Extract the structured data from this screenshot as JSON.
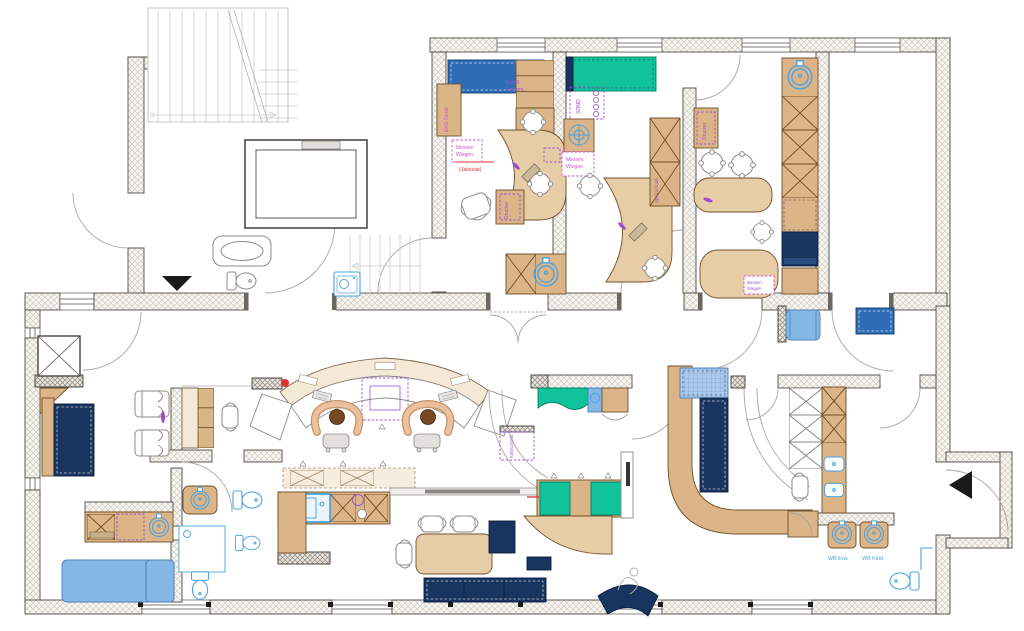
{
  "drawing": {
    "type": "architectural-floor-plan",
    "labels": {
      "notfall_line1": "Notfall",
      "notfall_line2": "Rollcont.",
      "ekg_geraet": "EKG Gerät",
      "messen_line1": "Messen",
      "messen_line2": "Wiegen",
      "jalousie_note": "(Jalousie)",
      "sono": "SONO",
      "drucker": "Drucker",
      "spritzschrank": "Spritzschrank",
      "kuehlschrank": "Kühlschrank",
      "wb_erw": "WB Erw.",
      "wb_kind": "WB Kind"
    },
    "colors": {
      "tan": "#dbb488",
      "tan-edge": "#6e4f28",
      "cream": "#f4e9d7",
      "blue": "#2e6db6",
      "teal": "#10c39b",
      "navy": "#17355f",
      "lightblue": "#85b7e4",
      "skyblue": "#4aa3e2",
      "purple": "#9b4fd0",
      "pink": "#d14fc8",
      "red": "#e03030",
      "skin": "#ecc09c",
      "hair": "#77481f",
      "wall-edge": "#4d4a45"
    }
  }
}
